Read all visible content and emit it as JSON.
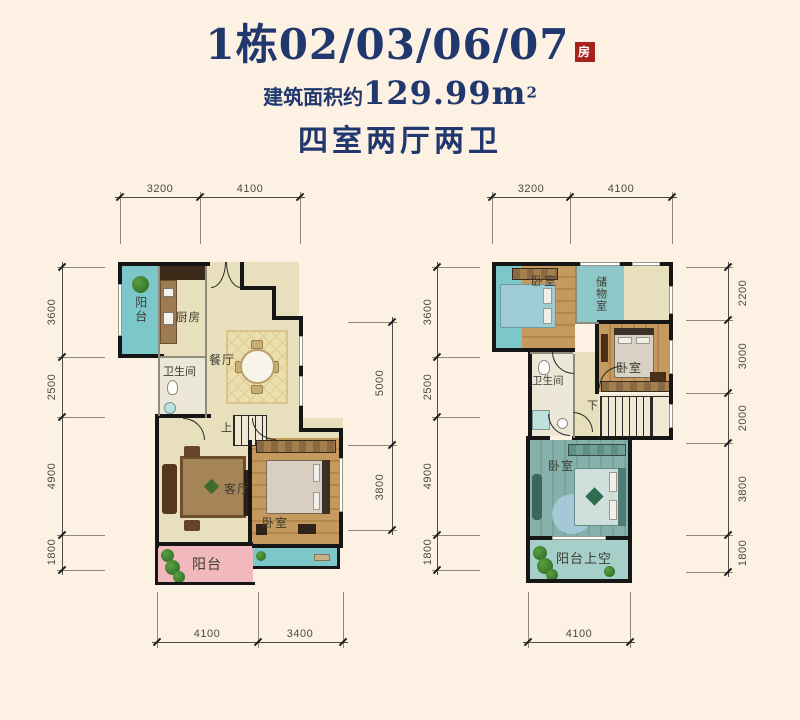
{
  "header": {
    "title": "1栋02/03/06/07",
    "badge": "房",
    "area_prefix": "建筑面积约",
    "area_value": "129.99m",
    "area_exponent": "2",
    "layout_type": "四室两厅两卫"
  },
  "colors": {
    "background": "#fcf1e2",
    "title_navy": "#20386e",
    "badge_red": "#a5231d",
    "wall_black": "#161616",
    "floor_beige": "#e8e0bd",
    "balcony_teal": "#7cc7ca",
    "balcony_pink": "#f1b9bd",
    "wood_floor": "#c49a5e",
    "master_teal": "#84b2aa",
    "void_teal": "#a5cfc8"
  },
  "floor1": {
    "rooms": {
      "balcony_top": "阳台",
      "kitchen": "厨房",
      "bathroom": "卫生间",
      "dining": "餐厅",
      "living": "客厅",
      "bedroom": "卧室",
      "balcony_bottom": "阳台",
      "stairs": "上"
    },
    "dims": {
      "top": [
        "3200",
        "4100"
      ],
      "left": [
        "3600",
        "2500",
        "4900",
        "1800"
      ],
      "right": [
        "5000",
        "3800"
      ],
      "bottom": [
        "4100",
        "3400"
      ]
    }
  },
  "floor2": {
    "rooms": {
      "bedroom_nw": "卧室",
      "storage": "储物室",
      "bedroom_e": "卧室",
      "bathroom": "卫生间",
      "master": "卧室",
      "balcony_void": "阳台上空",
      "stairs": "下"
    },
    "dims": {
      "top": [
        "3200",
        "4100"
      ],
      "left": [
        "3600",
        "2500",
        "4900",
        "1800"
      ],
      "right": [
        "2200",
        "3000",
        "2000",
        "3800",
        "1800"
      ],
      "bottom": [
        "4100"
      ]
    }
  }
}
